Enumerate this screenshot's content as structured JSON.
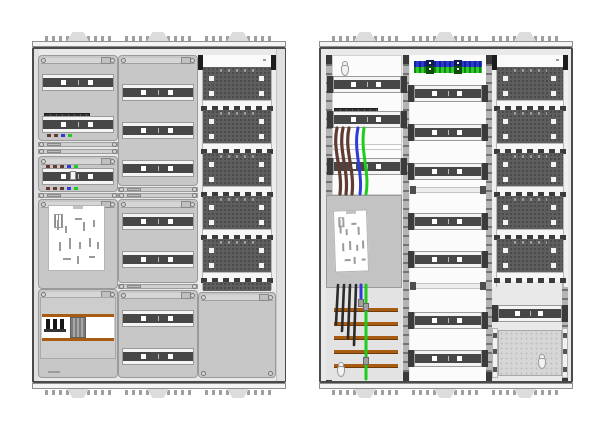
{
  "diagram": {
    "type": "electrical-distribution-cabinet-drawing",
    "views": [
      {
        "id": "left",
        "label": "cabinet-with-front-covers"
      },
      {
        "id": "right",
        "label": "cabinet-open-with-wiring"
      }
    ]
  },
  "colors": {
    "page_bg": "#ffffff",
    "frame_border": "#4a4a4a",
    "frame_bg": "#e9e9e9",
    "cover": "#c7c7c7",
    "cover_top": "#d6d6d6",
    "panel_white": "#fbfbfb",
    "rail_dark": "#474747",
    "rail_strip": "#f4f4f4",
    "perforated": "#5e5e5e",
    "perforated_hole": "#434343",
    "comb_white": "#f6f6f6",
    "comb_tooth": "#3c3c3c",
    "busbar_copper": "#a85c12",
    "busbar_copper_dark": "#6d3a08",
    "wire_brown": "#5f3b31",
    "wire_blue": "#2f3bd4",
    "wire_green": "#1ecb1e",
    "wire_black": "#2b2b2b",
    "terminal_blue": "#2a3ad0",
    "terminal_blue_dark": "#13209a",
    "terminal_green": "#2ecb2e",
    "terminal_green_dark": "#128a12",
    "meter_plate": "#c3c3c3",
    "sticker": "#ffffff",
    "screw": "#d8d8d8"
  },
  "left_cabinet": {
    "column1": {
      "section1": {
        "rails": 2,
        "breaker_row": true,
        "terminal_dot_colors": [
          "brown",
          "brown",
          "blue",
          "green"
        ]
      },
      "section2": {
        "rails": 1,
        "terminal_dot_colors": [
          "brown",
          "brown",
          "brown",
          "blue",
          "green"
        ]
      },
      "section3": {
        "content": "meter-field-sticker"
      },
      "section4": {
        "content": "sls-main-switch-on-busbar",
        "poles": 3
      }
    },
    "column2": {
      "sections_rails": [
        3,
        2,
        2
      ]
    },
    "column3": {
      "perforated_units": 5,
      "comb_teeth": 7,
      "bottom": "blank-cover"
    }
  },
  "right_cabinet": {
    "column1": {
      "upper_rails": 3,
      "breaker_row": true,
      "feed_wires": [
        "brown",
        "brown",
        "brown",
        "blue",
        "green"
      ],
      "meter_plate_sticker": true,
      "busbars": 5,
      "drop_wires": [
        "black",
        "black",
        "black",
        "black"
      ],
      "neutral_wire": "blue",
      "earth_wire": "green"
    },
    "column2": {
      "terminal_strips": [
        "blue",
        "green"
      ],
      "sections_rails": [
        3,
        2,
        2
      ]
    },
    "column3": {
      "perforated_units": 5,
      "din_rails": 1,
      "bottom": "perforated-mounting-plate"
    }
  }
}
